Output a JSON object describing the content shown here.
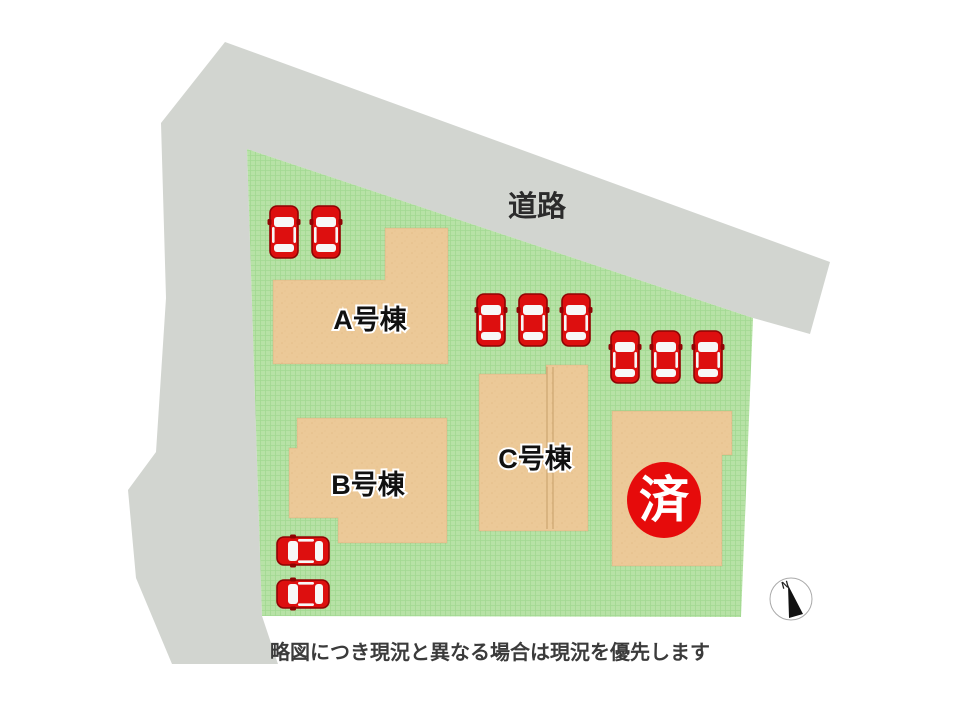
{
  "page": {
    "road_label": "道路",
    "note": "略図につき現況と異なる場合は現況を優先します",
    "compass_label": "N"
  },
  "colors": {
    "road": "#d2d5d0",
    "grass": "#b7e2a6",
    "grass_grid": "#8ecf7f",
    "building": "#ecc998",
    "building_speckle": "#dcb076",
    "building_seam": "#b98f58",
    "car_body": "#dd0f0f",
    "car_dark": "#8f0404",
    "car_window": "#f7f7f7",
    "badge": "#e60b0b",
    "label_text": "#111111",
    "note_text": "#3b3b3b"
  },
  "site": {
    "road_polygon": "225,42 830,262 810,334 753,318 247,149 262,616 278,664 172,664 136,578 128,490 156,452 166,298 161,123",
    "grass_polygon": "247,149 753,318 741,617 262,616",
    "road_label_pos": {
      "x": 537,
      "y": 216
    },
    "note_pos": {
      "x": 490,
      "y": 659
    },
    "buildings": [
      {
        "name": "A号棟",
        "points": "273,280 385,280 385,228 448,228 448,364 273,364",
        "label_x": 370,
        "label_y": 329
      },
      {
        "name": "B号棟",
        "points": "297,418 447,418 447,543 338,543 338,518 289,518 289,448 297,448",
        "label_x": 368,
        "label_y": 494
      },
      {
        "name": "C号棟",
        "points": "479,374 546,374 546,365 588,365 588,531 479,531",
        "label_x": 535,
        "label_y": 468,
        "seams": [
          {
            "x1": 547,
            "y1": 367,
            "x2": 547,
            "y2": 529
          },
          {
            "x1": 553,
            "y1": 367,
            "x2": 553,
            "y2": 529
          }
        ]
      },
      {
        "name": "",
        "points": "612,411 732,411 732,455 722,455 722,566 612,566"
      }
    ],
    "sold_badge": {
      "label": "済",
      "cx": 664,
      "cy": 500,
      "rx": 37,
      "ry": 38
    },
    "cars": [
      {
        "x": 284,
        "y": 232,
        "dir": "up"
      },
      {
        "x": 326,
        "y": 232,
        "dir": "up"
      },
      {
        "x": 491,
        "y": 320,
        "dir": "up"
      },
      {
        "x": 533,
        "y": 320,
        "dir": "up"
      },
      {
        "x": 576,
        "y": 320,
        "dir": "up"
      },
      {
        "x": 625,
        "y": 357,
        "dir": "up"
      },
      {
        "x": 666,
        "y": 357,
        "dir": "up"
      },
      {
        "x": 708,
        "y": 357,
        "dir": "up"
      },
      {
        "x": 303,
        "y": 551,
        "dir": "left"
      },
      {
        "x": 303,
        "y": 594,
        "dir": "left"
      }
    ],
    "compass": {
      "cx": 791,
      "cy": 599,
      "r": 21,
      "needle": "788,585 803,614 789,618",
      "n_x": 786,
      "n_y": 588
    }
  }
}
